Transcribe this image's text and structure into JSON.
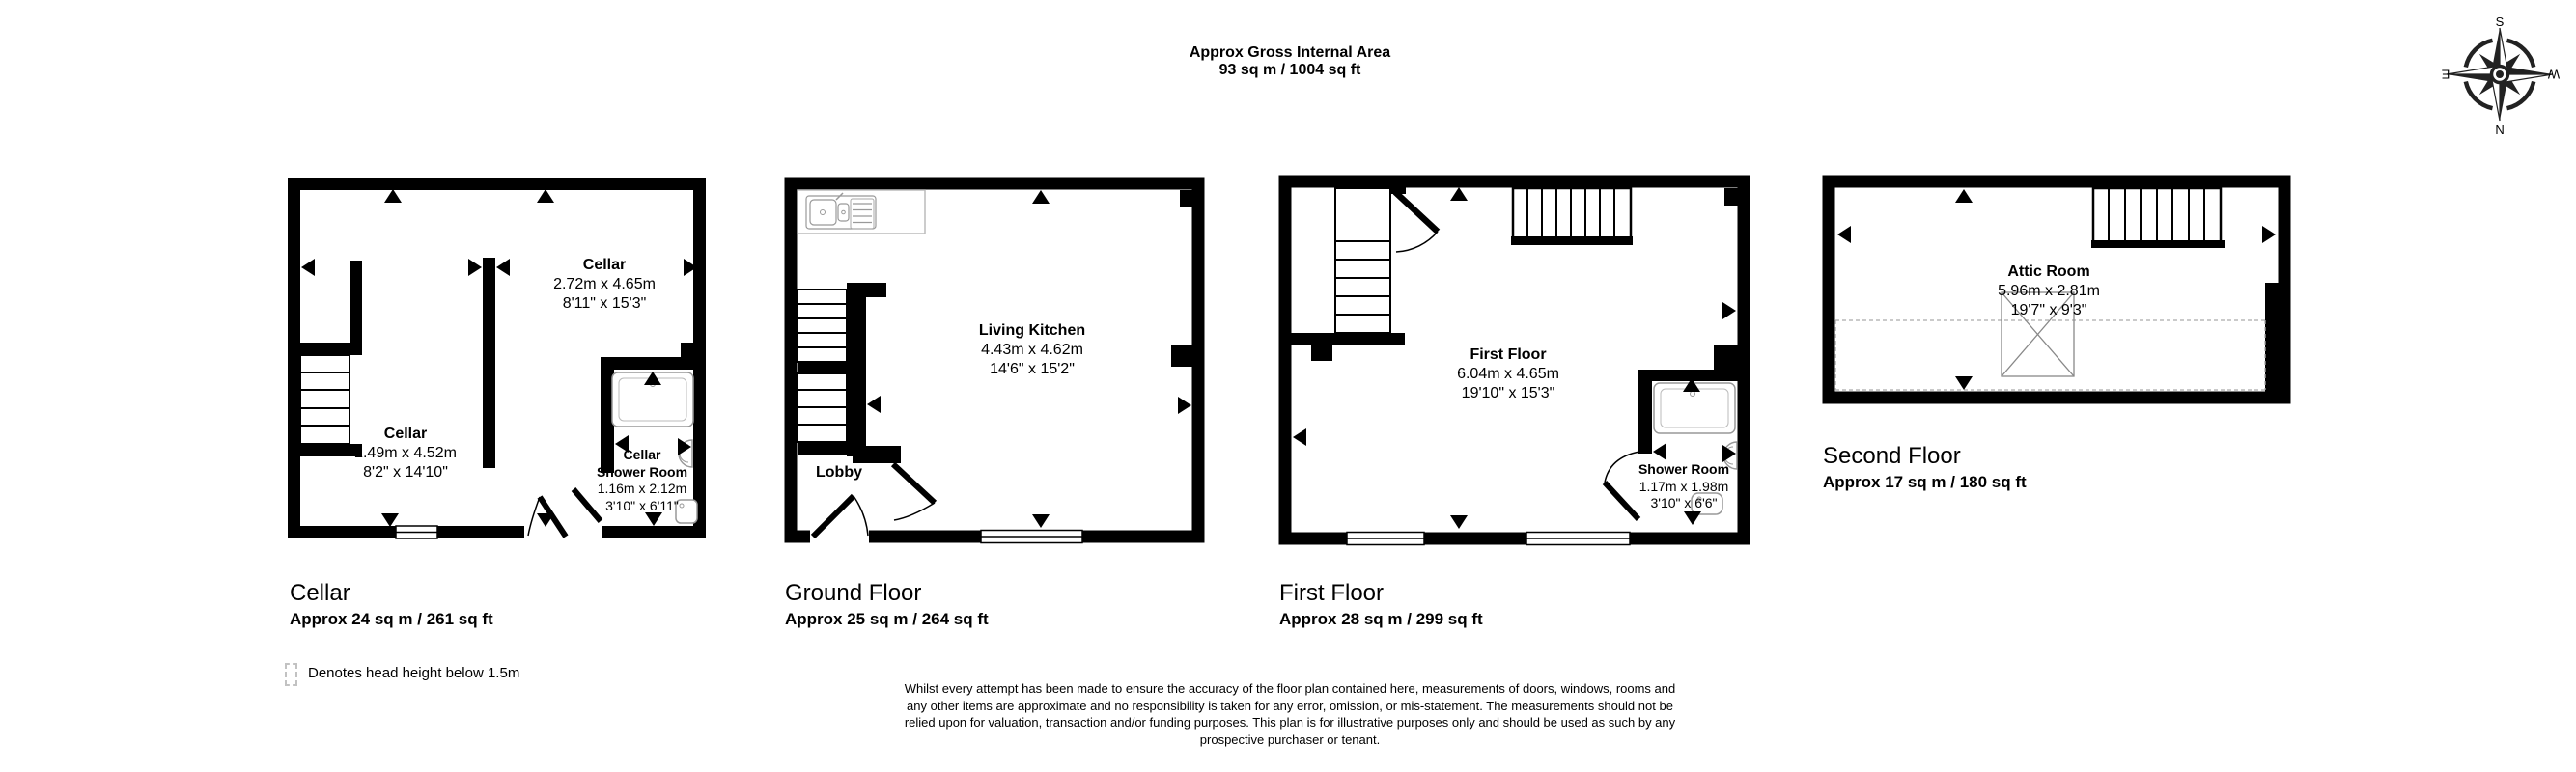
{
  "header": {
    "title_line1": "Approx Gross Internal Area",
    "title_line2": "93 sq m / 1004 sq ft"
  },
  "compass": {
    "n": "N",
    "s": "S",
    "e": "E",
    "w": "W"
  },
  "plans": [
    {
      "title": "Cellar",
      "area": "Approx 24 sq m / 261 sq ft",
      "rooms": {
        "upper": {
          "name": "Cellar",
          "metric": "2.72m x 4.65m",
          "imperial": "8'11\" x 15'3\""
        },
        "lower": {
          "name": "Cellar",
          "metric": "2.49m x 4.52m",
          "imperial": "8'2\" x 14'10\""
        },
        "shower": {
          "name1": "Cellar",
          "name2": "Shower Room",
          "metric": "1.16m x 2.12m",
          "imperial": "3'10\" x 6'11\""
        }
      }
    },
    {
      "title": "Ground Floor",
      "area": "Approx 25 sq m / 264 sq ft",
      "rooms": {
        "living_kitchen": {
          "name": "Living Kitchen",
          "metric": "4.43m x 4.62m",
          "imperial": "14'6\" x 15'2\""
        },
        "lobby": {
          "name": "Lobby"
        }
      }
    },
    {
      "title": "First Floor",
      "area": "Approx 28 sq m / 299 sq ft",
      "rooms": {
        "main": {
          "name": "First Floor",
          "metric": "6.04m x 4.65m",
          "imperial": "19'10\" x 15'3\""
        },
        "shower": {
          "name": "Shower Room",
          "metric": "1.17m x 1.98m",
          "imperial": "3'10\" x 6'6\""
        }
      }
    },
    {
      "title": "Second Floor",
      "area": "Approx 17 sq m / 180 sq ft",
      "rooms": {
        "attic": {
          "name": "Attic Room",
          "metric": "5.96m x 2.81m",
          "imperial": "19'7\" x 9'3\""
        }
      }
    }
  ],
  "legend": {
    "text": "Denotes head height below 1.5m"
  },
  "disclaimer": {
    "line1": "Whilst every attempt has been made to ensure the accuracy of the floor plan contained here, measurements of doors, windows, rooms and",
    "line2": "any other items are approximate and no responsibility is taken for any error, omission, or mis-statement. The measurements should not be",
    "line3": "relied upon for valuation, transaction and/or funding purposes. This plan is for illustrative purposes only and should be used as such by any",
    "line4": "prospective purchaser or tenant."
  },
  "colors": {
    "wall": "#000000",
    "fixture": "#999999",
    "dashed": "#aaaaaa"
  }
}
